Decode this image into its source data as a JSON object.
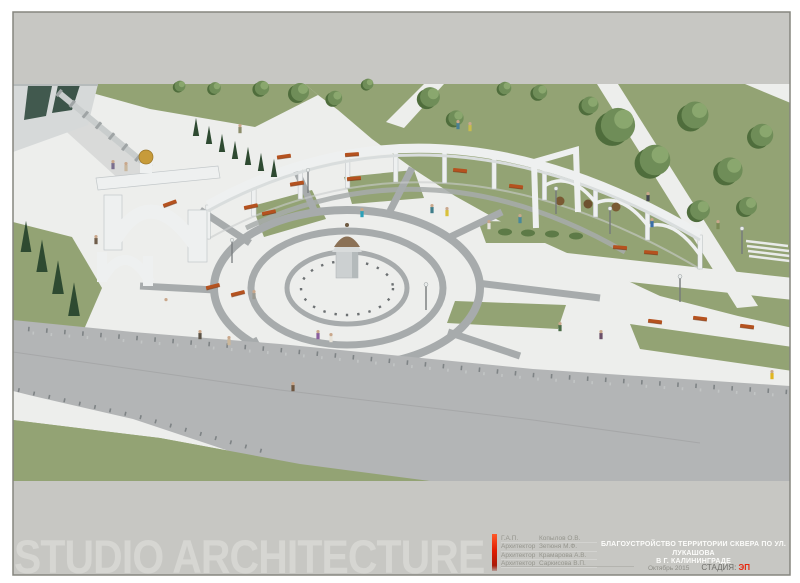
{
  "sheet": {
    "watermark": "STUDIO ARCHITECTURE",
    "project_title_line1": "БЛАГОУСТРОЙСТВО ТЕРРИТОРИИ СКВЕРА ПО УЛ. ЛУКАШОВА",
    "project_title_line2": "В  Г. КАЛИНИНГРАДЕ",
    "date": "Октябрь  2015",
    "stage_label": "СТАДИЯ:",
    "stage_value": "ЭП",
    "credits": [
      {
        "role": "Г.А.П.",
        "name": "Копылов О.В."
      },
      {
        "role": "Архитектор",
        "name": "Зетюня М.Ф."
      },
      {
        "role": "Архитектор",
        "name": "Крамарова А.В."
      },
      {
        "role": "Архитектор",
        "name": "Саркисова В.П."
      }
    ]
  },
  "scene": {
    "features": [
      "circular-plaza",
      "central-domed-monument",
      "curved-colonnade",
      "arch-gate-with-gold-sphere",
      "entrance-building",
      "retaining-wall",
      "cypress-rows",
      "lawns-with-trees",
      "orange-benches",
      "street-lamps",
      "bollard-rows",
      "diagonal-road",
      "pedestrians"
    ],
    "colors": {
      "c-sky": "#c7c7c3",
      "c-paving": "#edeeec",
      "c-band": "#a7abac",
      "c-road": "#b3b5b6",
      "c-grass": "#93a374",
      "c-structure": "#eef0f0",
      "c-bench": "#b5521f",
      "c-cypress": "#2e4a31",
      "c-tree": "#6f8d58",
      "c-treedark": "#4f6d3c",
      "c-treelight": "#8aa76e",
      "c-gold": "#c79b3a",
      "c-dome": "#8b7156",
      "c-watermark": "#d6d6d2",
      "c-textgray": "#95958d",
      "c-titlewhite": "#fcfcfa",
      "c-accentred": "#e8250c"
    }
  }
}
